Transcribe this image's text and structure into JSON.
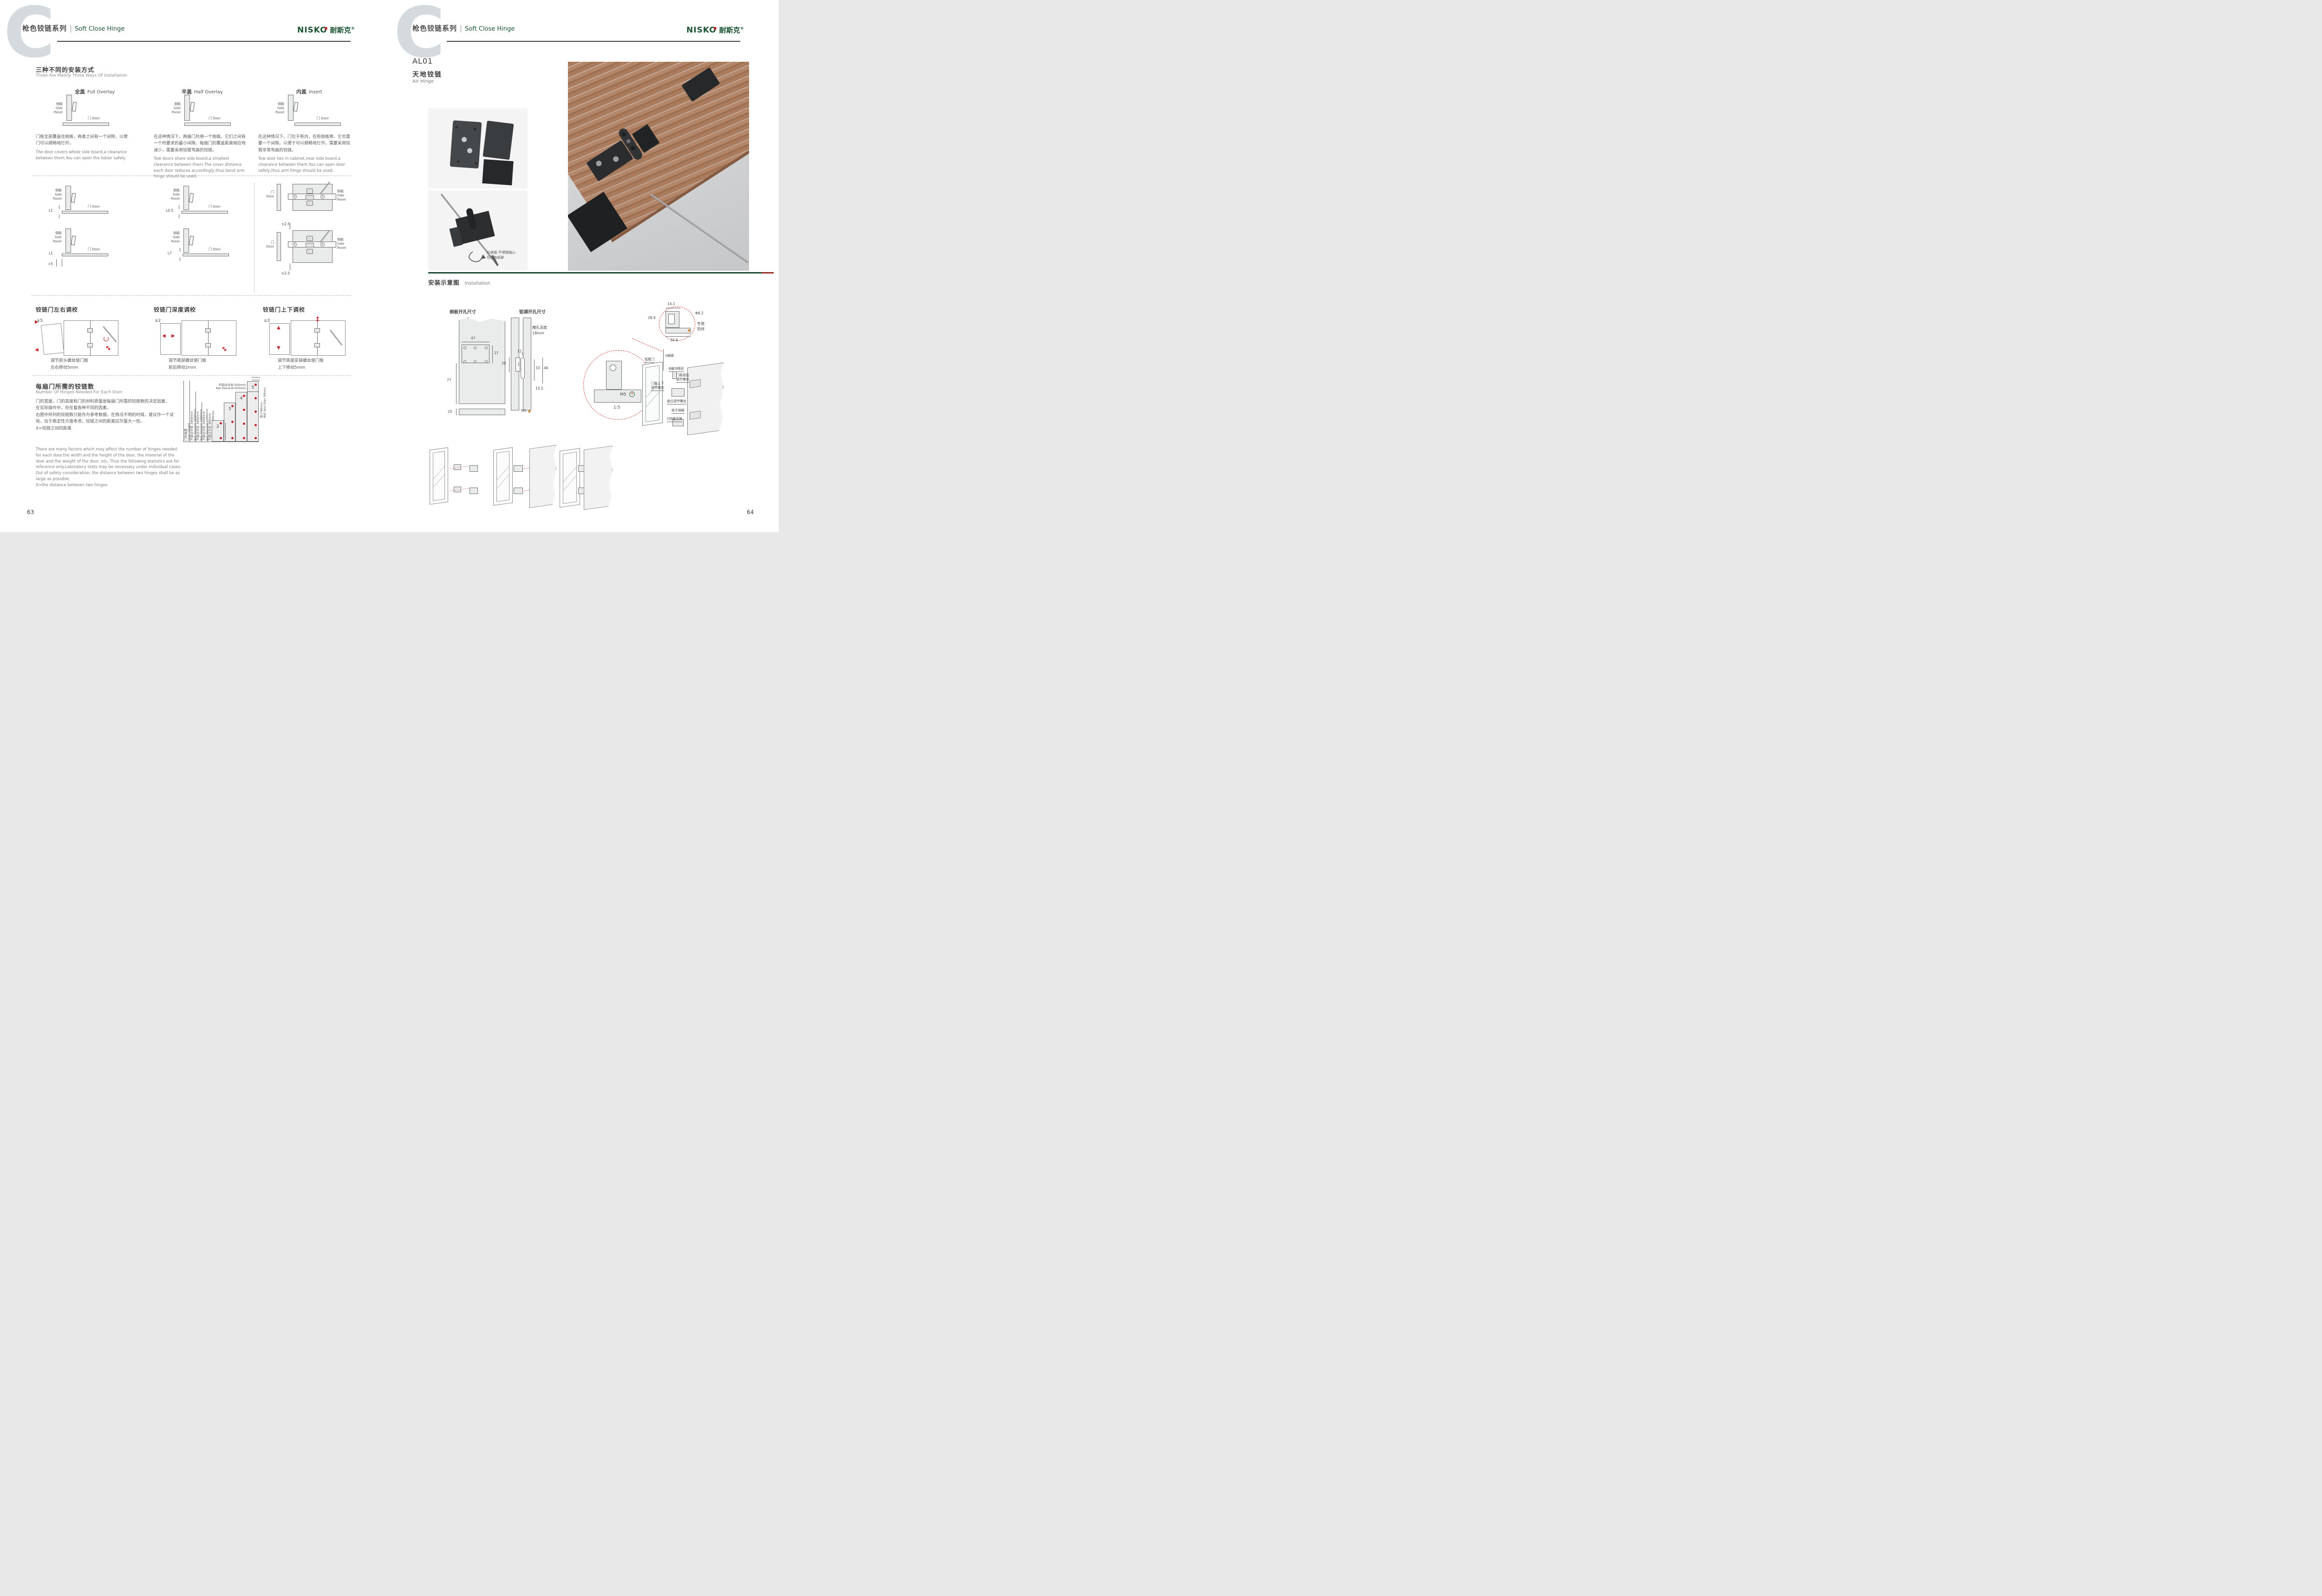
{
  "header": {
    "watermark": "C",
    "series_cn": "枪色铰链系列",
    "series_en": "Soft Close Hinge"
  },
  "brand": {
    "logo_en": "NISKO",
    "logo_cn": "耐斯克",
    "reg": "®"
  },
  "left_page": {
    "page_number": "63",
    "ways": {
      "title_cn": "三种不同的安装方式",
      "title_en": "Three Are Mainly Three Ways Of Installation",
      "columns": [
        {
          "name_cn": "全盖",
          "name_en": "Full Overlay",
          "desc_cn": "门板全部覆盖住侧板，两者之间有一个间隙，以便门可以顺畅地打开。",
          "desc_en": "The door covers whole side board,a clearance between them,You can open the bdoor safely."
        },
        {
          "name_cn": "半盖",
          "name_en": "Half Overlay",
          "desc_cn": "在这种情况下，两扇门共用一个侧板。它们之间有一个所要求的最小间隙。每扇门的覆盖距离相应地减少，需要采用铰臂弯曲的铰链。",
          "desc_en": "Tow doors share side board,a smallest clearance between them,The cover distance each door reduces accordingly,thus bend arm hinge should be used."
        },
        {
          "name_cn": "内盖",
          "name_en": "Insert",
          "desc_cn": "在这种情况下，门位于柜内，在柜侧板旁。它也需要一个间隙。以便于可以顺畅地打开。需要采用铰臂非常弯曲的铰链。",
          "desc_en": "Tow door lies in cabinet,near side board,a clearance between them.You can open door safely,thus arm hinge should be used."
        }
      ]
    },
    "mid": {
      "sp_cn": "侧板",
      "sp_en1": "Side",
      "sp_en2": "Panel",
      "door_cn": "门",
      "door_en": "Door",
      "dim_r1c1": "L1",
      "dim_r1c2": "L0.5",
      "dim_r2c1": "L1",
      "dim_r2c1b": "+5",
      "dim_r2c2": "L7",
      "dim_c3_top": "±2.5",
      "dim_c3_bottom": "±2.5"
    },
    "adjustments": [
      {
        "title": "铰链门左右调校",
        "tol": "±5",
        "cap1": "调节前头螺丝使门板",
        "cap2": "左右移动5mm"
      },
      {
        "title": "铰链门深度调校",
        "tol": "±2",
        "cap1": "调节尾部螺丝使门板",
        "cap2": "前后移动2mm"
      },
      {
        "title": "铰链门上下调校",
        "tol": "±2",
        "cap1": "调节底座安装螺丝使门板",
        "cap2": "上下移动5mm"
      }
    ],
    "hinge_count": {
      "title_cn": "每扇门所需的铰链数",
      "title_en": "Number Of Hinges Needed For Each Door",
      "desc_cn_1": "门的宽度，门的高度和门的材料质量是每扇门所需的铰链数的决定因素。",
      "desc_cn_2": "在实际操作中，存在着各种不同的因素。",
      "desc_cn_3": "右图中所列的铰链数只能作为参考数据，在情况不明的时候，建议作一个试验，出于稳定性方面考虑，铰链之间的距离应尽量大一些。",
      "desc_cn_4": "X=铰链之间的距离",
      "desc_en_1": "There are many factors which may affect the number of hinges needed for each door.the width and the height of the door, the material of the door and the weight of the door, etc, Thus the following statistics are for reference only.Laboratory tests may be necessary under individual cases.",
      "desc_en_2": "Out of safety consideration, the distance between two hinges shall be as large as possible.",
      "desc_en_3": "X=the distance between two hinges"
    }
  },
  "chart_data": {
    "type": "bar",
    "title_cn": "每扇门所需的铰链数",
    "title_en": "Number Of Hinges Needed For Each Door",
    "ylabel_cn": "门的高度",
    "ylabel_en": "Door height",
    "categories": [
      "2",
      "3",
      "4",
      "5"
    ],
    "values": [
      900,
      1600,
      2000,
      2400
    ],
    "unit": "mm max door height per hinge count",
    "bars": [
      {
        "hinges": "2",
        "max_mm": 900,
        "limit_cn": "不超过计划 900mm",
        "limit_en": "Not bevond 900mm"
      },
      {
        "hinges": "3",
        "max_mm": 1600,
        "limit_cn": "不超过计划 1600mm",
        "limit_en": "Not bevond 1600mm"
      },
      {
        "hinges": "4",
        "max_mm": 2000,
        "limit_cn": "不超过计划 2000mm",
        "limit_en": "Not bevond 2000mm"
      },
      {
        "hinges": "5",
        "max_mm": 2400,
        "limit_cn": "不超过计划 2400mm",
        "limit_en": "Not bevond 2400mm"
      }
    ],
    "door_width_cn": "不超过计划 600mm",
    "door_width_en": "Not bevond 600mm",
    "edge_cn": "至少90mm",
    "edge_en": "Not less than 90mm"
  },
  "right_page": {
    "page_number": "64",
    "product": {
      "code": "AL01",
      "name_cn": "天地铰链",
      "name_en": "Air Hinge"
    },
    "photo_note_1": "升级版·不锈钢轴心",
    "photo_note_2": "可自由拆卸",
    "installation_title_cn": "安装示意图",
    "installation_title_en": "Installation",
    "drill_left_title": "侧板开孔尺寸",
    "drill_right_title": "铝调开孔尺寸",
    "dims": {
      "d47": "47",
      "d27": "27",
      "d77": "77",
      "d25": "25",
      "d20": "20",
      "d8": "8",
      "d11": "11",
      "d12": "12",
      "d1": "1",
      "d33": "33",
      "d46": "46",
      "d155": "15.5",
      "m5": "M5",
      "slot_1": "槽孔深度",
      "slot_2": "18mm",
      "m5b": "M5",
      "scale": "1:5",
      "d141": "14.1",
      "d289": "28.9",
      "d62": "Φ6.2",
      "d349": "34.9",
      "alu_1": "专用",
      "alu_2": "铝材"
    },
    "exploded": {
      "frame": "铝框门",
      "pin": "A插销",
      "damper": "B缓冲阻尼",
      "fb_1": "门板前后",
      "fb_2": "调节螺丝",
      "ud_1": "门板上下",
      "ud_2": "调节螺丝",
      "cover": "盖位调节螺丝",
      "side": "柜子侧板",
      "body": "C铰链主体"
    }
  }
}
